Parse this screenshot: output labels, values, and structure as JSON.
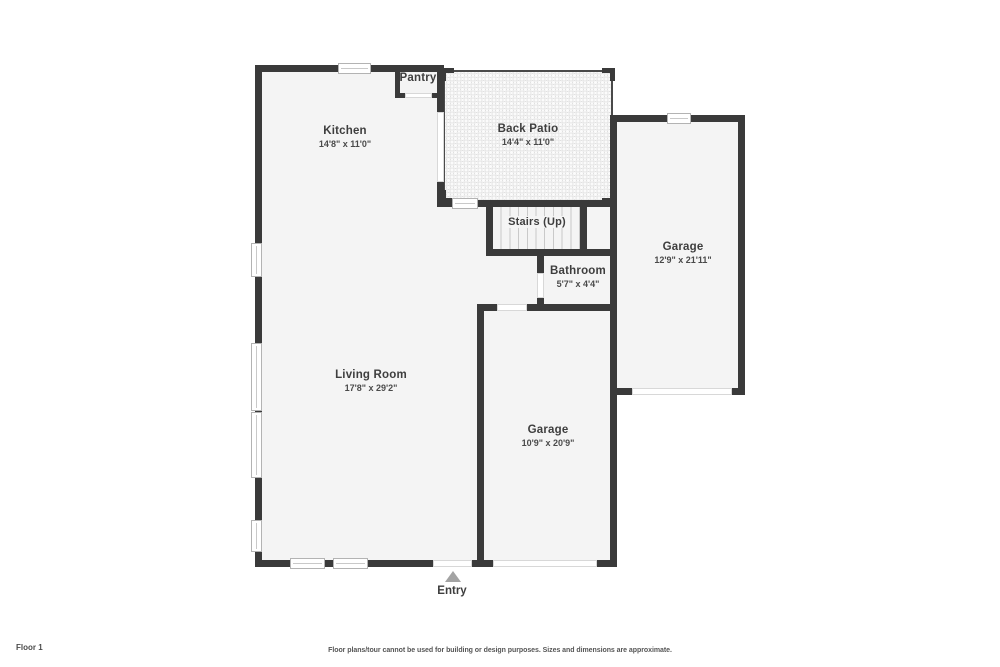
{
  "floorplan": {
    "rooms": [
      {
        "id": "kitchen",
        "name": "Kitchen",
        "dimensions": "14'8\" x 11'0\""
      },
      {
        "id": "back-patio",
        "name": "Back Patio",
        "dimensions": "14'4\" x 11'0\""
      },
      {
        "id": "pantry",
        "name": "Pantry",
        "dimensions": ""
      },
      {
        "id": "garage-right",
        "name": "Garage",
        "dimensions": "12'9\" x 21'11\""
      },
      {
        "id": "stairs",
        "name": "Stairs (Up)",
        "dimensions": ""
      },
      {
        "id": "bathroom",
        "name": "Bathroom",
        "dimensions": "5'7\" x 4'4\""
      },
      {
        "id": "living-room",
        "name": "Living Room",
        "dimensions": "17'8\" x 29'2\""
      },
      {
        "id": "garage-bottom",
        "name": "Garage",
        "dimensions": "10'9\" x 20'9\""
      }
    ],
    "entry_label": "Entry",
    "colors": {
      "wall": "#3a3a3a",
      "interior_floor": "#f4f4f4",
      "outdoor": "#ffffff",
      "window_border": "#b3b3b3",
      "entry_arrow": "#a3a3a3",
      "label_text": "#3e3e3e",
      "stair_tread": "#c9c9c9",
      "patio_dot": "#e0e0e0"
    }
  },
  "footer": {
    "floor_label": "Floor 1",
    "disclaimer": "Floor plans/tour cannot be used for building or design purposes. Sizes and dimensions are approximate."
  }
}
